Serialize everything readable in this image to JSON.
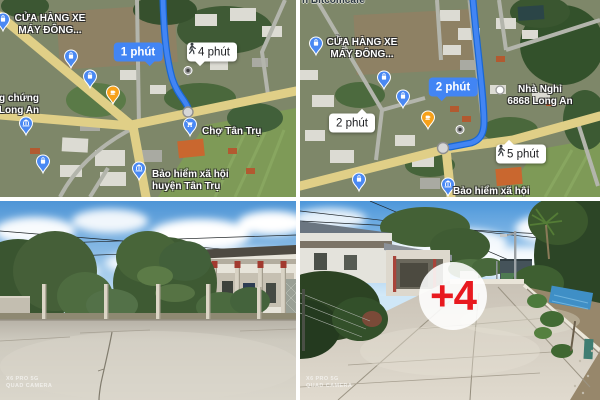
{
  "gallery_title": "property-listing-photo-gallery",
  "maps": {
    "left": {
      "poi": {
        "shop_line1": "CỬA HÀNG XE",
        "shop_line2": "MÁY ĐÔNG...",
        "notary_line1": "g chứng",
        "notary_line2": "Long An",
        "market": "Chợ Tân Trụ",
        "insurance_line1": "Bảo hiểm xã hội",
        "insurance_line2": "huyện Tân Trụ"
      },
      "badges": {
        "drive": "1 phút",
        "walk": "4 phút"
      }
    },
    "right": {
      "poi": {
        "cafe": "n Bitcomcafe",
        "shop_line1": "CỬA HÀNG XE",
        "shop_line2": "MÁY ĐÔNG...",
        "hotel_line1": "Nhà Nghỉ",
        "hotel_line2": "6868 Long An",
        "insurance_line1": "Bảo hiểm xã hội",
        "insurance_line2": "huyện Tân Trụ"
      },
      "badges": {
        "drive_far": "2 phút",
        "drive_near": "2 phút",
        "walk": "5 phút"
      }
    }
  },
  "photos": {
    "left": {
      "watermark1": "X6 PRO 5G",
      "watermark2": "QUAD CAMERA"
    },
    "right": {
      "watermark1": "X6 PRO 5G",
      "watermark2": "QUAD CAMERA",
      "more": "+4"
    }
  },
  "icons": {
    "walk": "walking-person-icon",
    "shop_pin": "shopping-bag-pin-icon",
    "market_pin": "shopping-cart-pin-icon",
    "insurance_pin": "bank-pin-icon",
    "cafe_pin": "coffee-pin-icon",
    "waypoint_pin": "gray-waypoint-pin-icon",
    "hotel_dot": "poi-dot-icon"
  },
  "colors": {
    "route_blue": "#4285f4",
    "route_casing": "#1967d2",
    "road_yellow": "#e0cf87",
    "badge_blue": "#4285f4",
    "more_red": "#e8191f",
    "pin_blue": "#4a89f3",
    "pin_orange": "#f7a11a"
  }
}
